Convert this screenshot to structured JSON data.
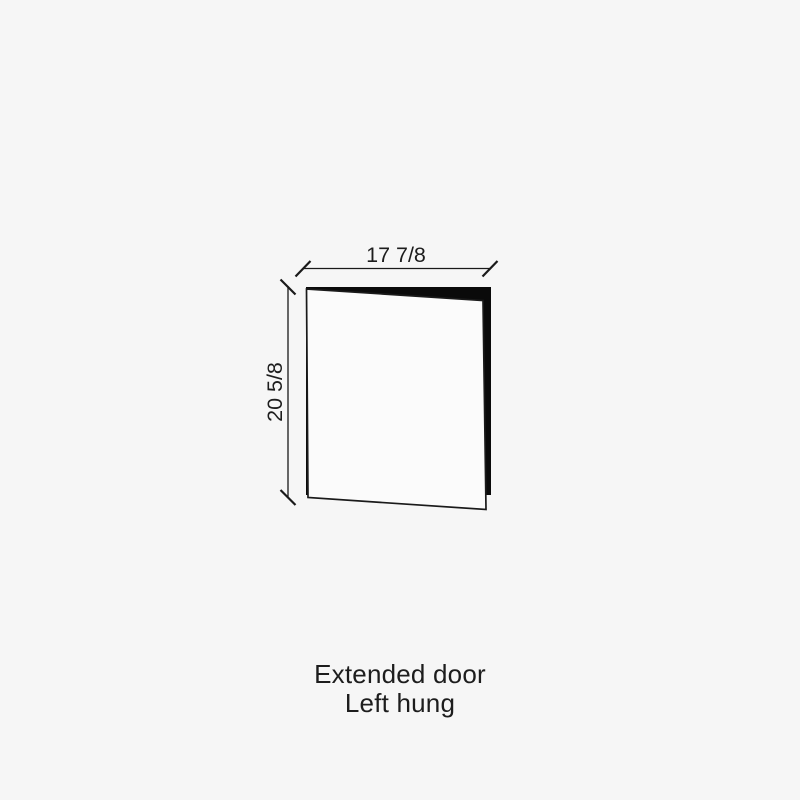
{
  "diagram": {
    "type": "door-elevation-drawing",
    "width_dimension": "17 7/8",
    "height_dimension": "20 5/8",
    "caption_line1": "Extended door",
    "caption_line2": "Left hung"
  },
  "colors": {
    "background": "#f6f6f6",
    "door_face": "#fbfbfb",
    "door_edge": "#0a0a0a",
    "line": "#1a1a1a",
    "text": "#1d1d1d"
  }
}
